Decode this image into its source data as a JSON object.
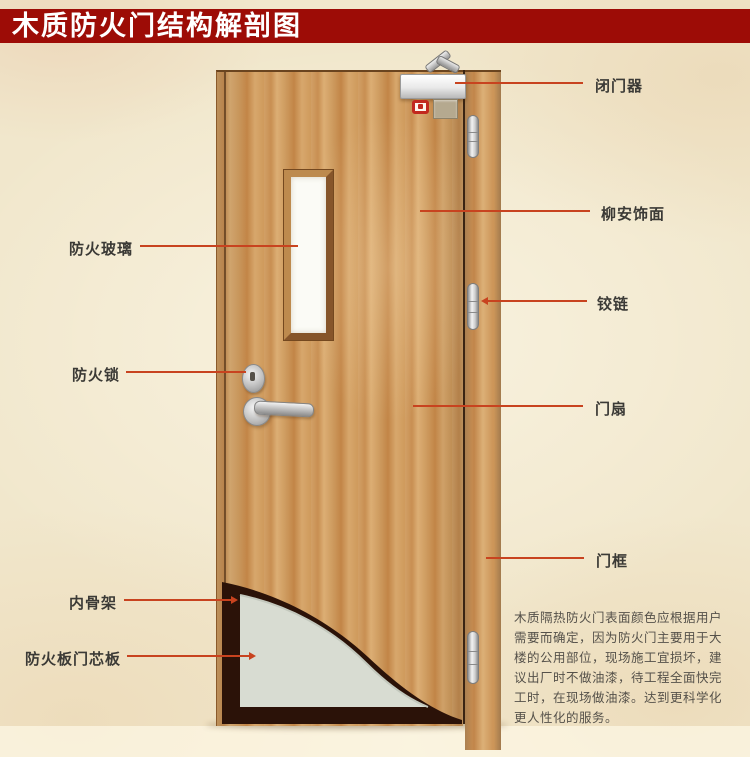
{
  "title": "木质防火门结构解剖图",
  "labels": {
    "door_closer": "闭门器",
    "veneer": "柳安饰面",
    "hinge": "铰链",
    "door_leaf": "门扇",
    "door_frame": "门框",
    "fire_glass": "防火玻璃",
    "fire_lock": "防火锁",
    "inner_skeleton": "内骨架",
    "core_board": "防火板门芯板"
  },
  "paragraph": {
    "lines": [
      "木质隔热防火门表面颜色应根据用户",
      "需要而确定，因为防火门主要用于大",
      "楼的公用部位，现场施工宜损坏，建",
      "议出厂时不做油漆，待工程全面快完",
      "工时，在现场做油漆。达到更科学化",
      "更人性化的服务。"
    ]
  },
  "colors": {
    "banner": "#9d0c06",
    "leader_line": "#c8431f",
    "wood_base": "#cf9b61",
    "core_panel": "#d8dcd2",
    "inner_frame": "#2b1208",
    "background": "#f1e7cc"
  }
}
